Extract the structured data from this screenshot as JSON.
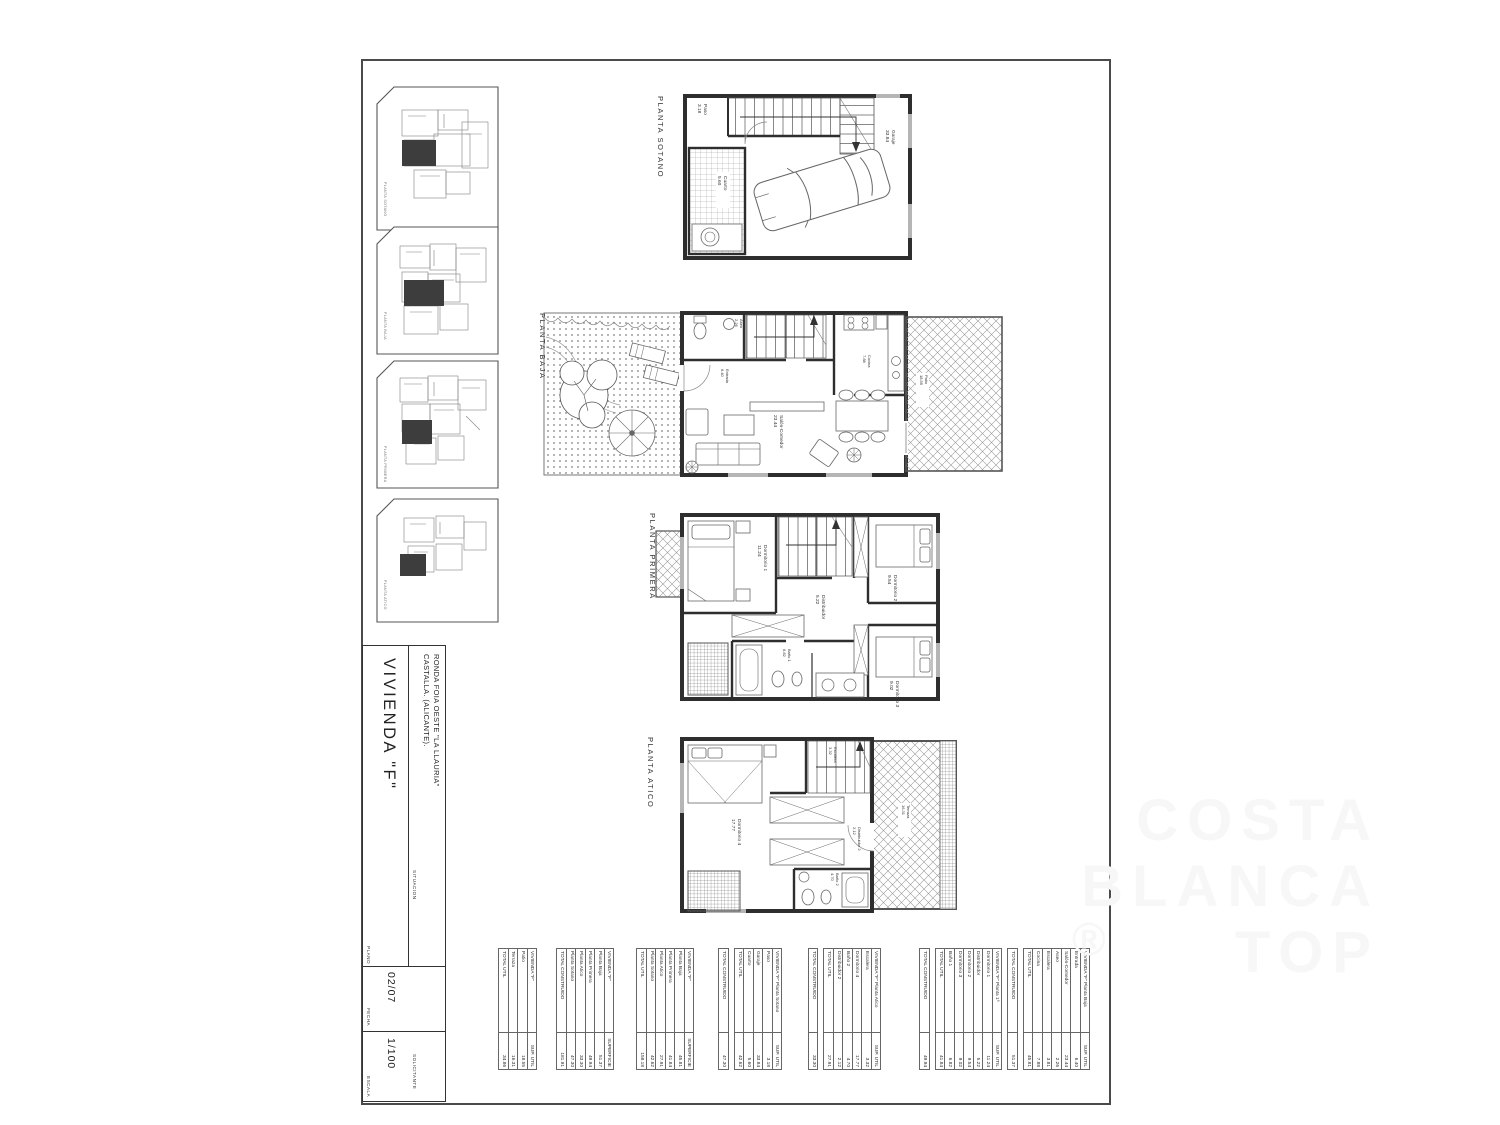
{
  "title_block": {
    "plano_label": "PLANO",
    "vivienda": "VIVIENDA \"F\"",
    "situacion_label": "SITUACION",
    "situacion_line1": "RONDA FOIA OESTE \"LA LLAURIA\"",
    "situacion_line2": "CASTALLA.  (ALICANTE).",
    "fecha_label": "FECHA",
    "fecha": "02/07",
    "escala_label": "ESCALA",
    "escala": "1/100",
    "solicitante_label": "SOLICITANTE"
  },
  "plans": {
    "sotano": {
      "label": "PLANTA SOTANO",
      "rooms": {
        "paso": {
          "name": "Paso",
          "area": "3.18"
        },
        "garaje": {
          "name": "Garaje",
          "area": "33.84"
        },
        "cuarto": {
          "name": "Cuarto",
          "area": "5.60"
        }
      }
    },
    "baja": {
      "label": "PLANTA BAJA",
      "unit_letter": "F",
      "rooms": {
        "aseo": {
          "name": "Aseo",
          "area": "2.26"
        },
        "entrada": {
          "name": "Entrada",
          "area": "6.40"
        },
        "cocina": {
          "name": "Cocina",
          "area": "7.88"
        },
        "salon": {
          "name": "Salón-Comedor",
          "area": "23.44"
        },
        "patio": {
          "name": "Patio",
          "area": "18.55"
        }
      }
    },
    "primera": {
      "label": "PLANTA PRIMERA",
      "rooms": {
        "dorm1": {
          "name": "Dormitorio 1",
          "area": "11.24"
        },
        "distribuidor": {
          "name": "Distribuidor",
          "area": "5.22"
        },
        "dorm2": {
          "name": "Dormitorio 2",
          "area": "9.54"
        },
        "dorm3": {
          "name": "Dormitorio 3",
          "area": "9.02"
        },
        "bano1": {
          "name": "Baño 1",
          "area": "6.82"
        }
      }
    },
    "atico": {
      "label": "PLANTA ATICO",
      "rooms": {
        "escalera": {
          "name": "Escalera",
          "area": "3.32"
        },
        "dorm4": {
          "name": "Dormitorio 4",
          "area": "17.77"
        },
        "distribuidor2": {
          "name": "Distribuidor 2",
          "area": "2.12"
        },
        "bano2": {
          "name": "Baño 2",
          "area": "4.70"
        },
        "terraza": {
          "name": "Terraza",
          "area": "16.31"
        }
      }
    }
  },
  "thumbnails": [
    {
      "label": "PLANTA SOTANO"
    },
    {
      "label": "PLANTA BAJA"
    },
    {
      "label": "PLANTA PRIMERA"
    },
    {
      "label": "PLANTA ATICO"
    }
  ],
  "tables": [
    {
      "id": "exterior",
      "header": "VIVIENDA \"F\"",
      "value_header": "SUP. UTIL",
      "rows": [
        {
          "name": "Patio",
          "value": "18.55"
        },
        {
          "name": "Terraza",
          "value": "16.31"
        }
      ],
      "total_label": "TOTAL UTIL",
      "total": "34.86"
    },
    {
      "id": "total-construido",
      "header": "VIVIENDA \"F\"",
      "value_header": "SUPERFICIE",
      "rows": [
        {
          "name": "Planta Baja",
          "value": "51.37"
        },
        {
          "name": "Planta Primera",
          "value": "49.94"
        },
        {
          "name": "Planta Atico",
          "value": "33.30"
        },
        {
          "name": "Planta Sotano",
          "value": "47.30"
        }
      ],
      "total_label": "TOTAL CONSTRUIDO",
      "total": "181.91"
    },
    {
      "id": "total-util",
      "header": "VIVIENDA \"F\"",
      "value_header": "SUPERFICIE",
      "rows": [
        {
          "name": "Planta Baja",
          "value": "45.81"
        },
        {
          "name": "Planta Primera",
          "value": "41.84"
        },
        {
          "name": "Planta Atico",
          "value": "27.91"
        },
        {
          "name": "Planta Sotano",
          "value": "42.62"
        }
      ],
      "total_label": "TOTAL UTIL",
      "total": "158.18"
    },
    {
      "id": "planta-sotano",
      "header": "VIVIENDA \"F\" Planta Sotano",
      "value_header": "SUP. UTIL",
      "rows": [
        {
          "name": "Paso",
          "value": "3.18"
        },
        {
          "name": "Garaje",
          "value": "33.84"
        },
        {
          "name": "Cuarto",
          "value": "5.60"
        }
      ],
      "total_label": "TOTAL UTIL",
      "total": "42.62",
      "constructed_label": "TOTAL CONSTRUIDO",
      "constructed": "47.30"
    },
    {
      "id": "planta-atico",
      "header": "VIVIENDA \"F\" Planta Atico",
      "value_header": "SUP. UTIL",
      "rows": [
        {
          "name": "Escalera",
          "value": "3.32"
        },
        {
          "name": "Dormitorio 4",
          "value": "17.77"
        },
        {
          "name": "Baño 2",
          "value": "4.70"
        },
        {
          "name": "Distribuidor 2",
          "value": "2.12"
        }
      ],
      "total_label": "TOTAL UTIL",
      "total": "27.91",
      "constructed_label": "TOTAL CONSTRUIDO",
      "constructed": "33.30"
    },
    {
      "id": "planta-primera",
      "header": "VIVIENDA \"F\" Planta 1ª",
      "value_header": "SUP. UTIL",
      "rows": [
        {
          "name": "Dormitorio 1",
          "value": "11.24"
        },
        {
          "name": "Distribuidor",
          "value": "5.22"
        },
        {
          "name": "Dormitorio 2",
          "value": "9.54"
        },
        {
          "name": "Dormitorio 3",
          "value": "9.02"
        },
        {
          "name": "Baño 1",
          "value": "6.82"
        }
      ],
      "total_label": "TOTAL UTIL",
      "total": "41.84",
      "constructed_label": "TOTAL CONSTRUIDO",
      "constructed": "49.94"
    },
    {
      "id": "planta-baja",
      "header": "VIVIENDA \"F\" Planta Baja",
      "value_header": "SUP. UTIL",
      "rows": [
        {
          "name": "Entrada",
          "value": "6.40"
        },
        {
          "name": "Salón-Comedor",
          "value": "23.44"
        },
        {
          "name": "Aseo",
          "value": "2.26"
        },
        {
          "name": "Escalera",
          "value": "3.81"
        },
        {
          "name": "Cocina",
          "value": "7.88"
        }
      ],
      "total_label": "TOTAL UTIL",
      "total": "45.81",
      "constructed_label": "TOTAL CONSTRUIDO",
      "constructed": "51.37"
    }
  ],
  "watermark": {
    "line1": "COSTA",
    "line2": "BLANCA",
    "line3": "TOP",
    "registered": "®"
  },
  "colors": {
    "wall": "#2e2e2e",
    "thin_line": "#666666",
    "window_fill": "#b5b5b5",
    "highlight_unit": "#3d3d3d",
    "watermark": "#f7f7f7"
  }
}
